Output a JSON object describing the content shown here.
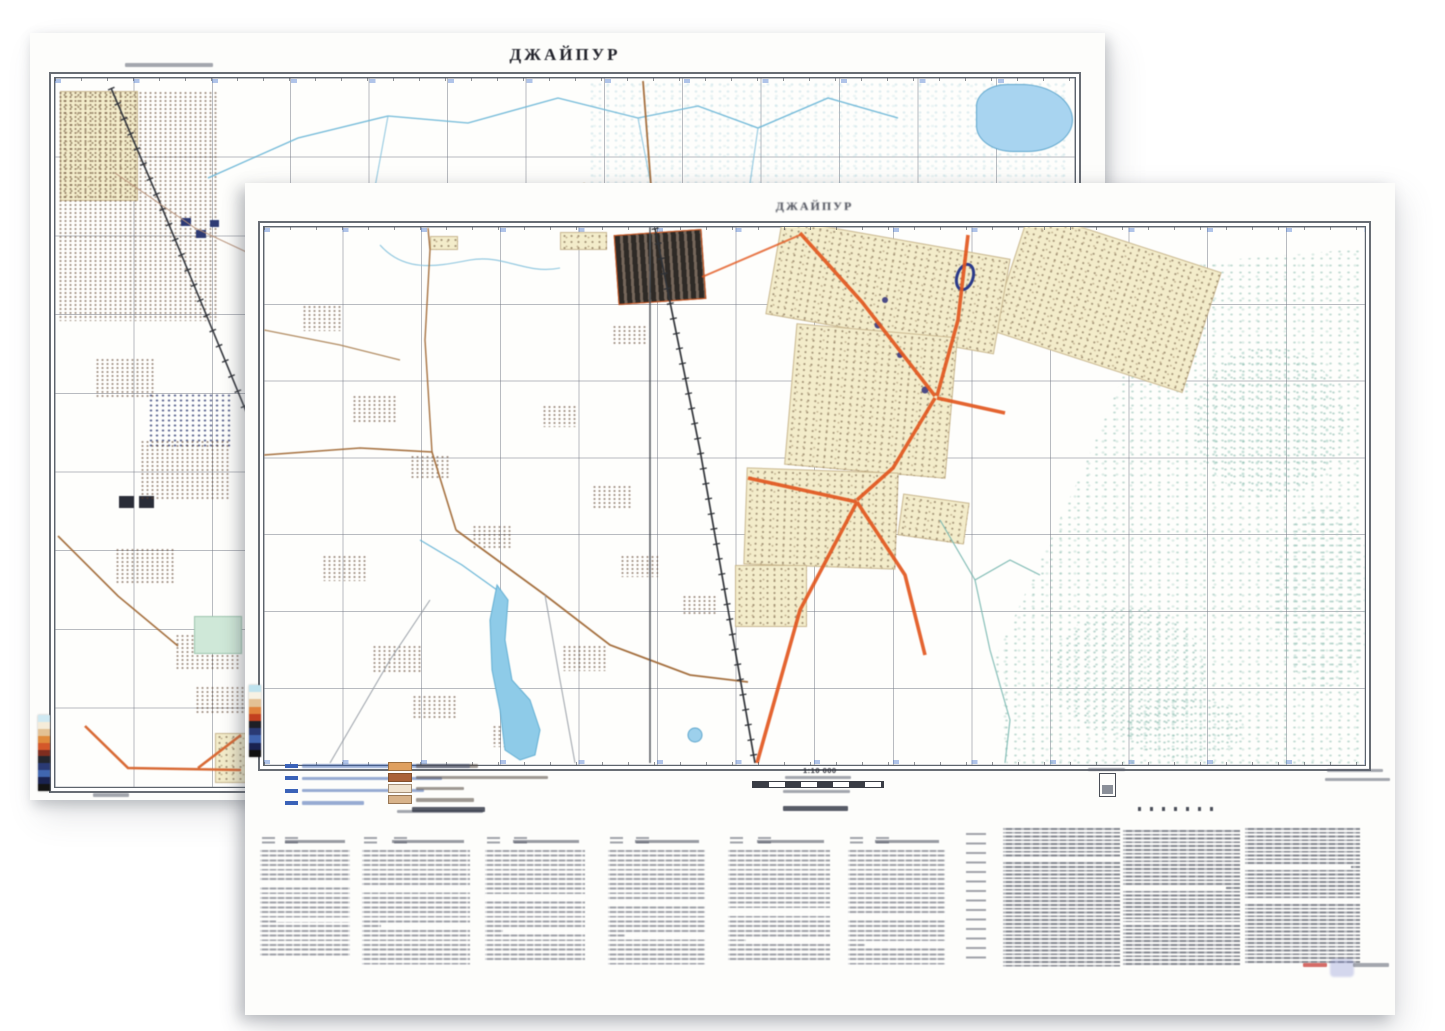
{
  "back_sheet": {
    "title": "ДЖАЙПУР",
    "colorbar": [
      "#cfe9f2",
      "#f5ecd9",
      "#e3c194",
      "#e08a3c",
      "#d4572a",
      "#7e2d1f",
      "#23262e",
      "#2a3a74",
      "#4066b0",
      "#1a2350",
      "#141414"
    ]
  },
  "front_sheet": {
    "title": "ДЖАЙПУР",
    "scale": "1:10 000",
    "colorbar": [
      "#bfe3ee",
      "#f7f2e4",
      "#e3c194",
      "#e0813a",
      "#c2401f",
      "#1d1f26",
      "#2a3a74",
      "#3f63ae",
      "#192250",
      "#101010"
    ],
    "legend": {
      "left_row_count": 4,
      "right_swatches": [
        "#dfa05f",
        "#aa6238",
        "#f0e3cf",
        "#d8b38a"
      ]
    },
    "index_table": {
      "column_group_count": 6
    },
    "description_block_count": 3,
    "security_mark_count": 7
  }
}
